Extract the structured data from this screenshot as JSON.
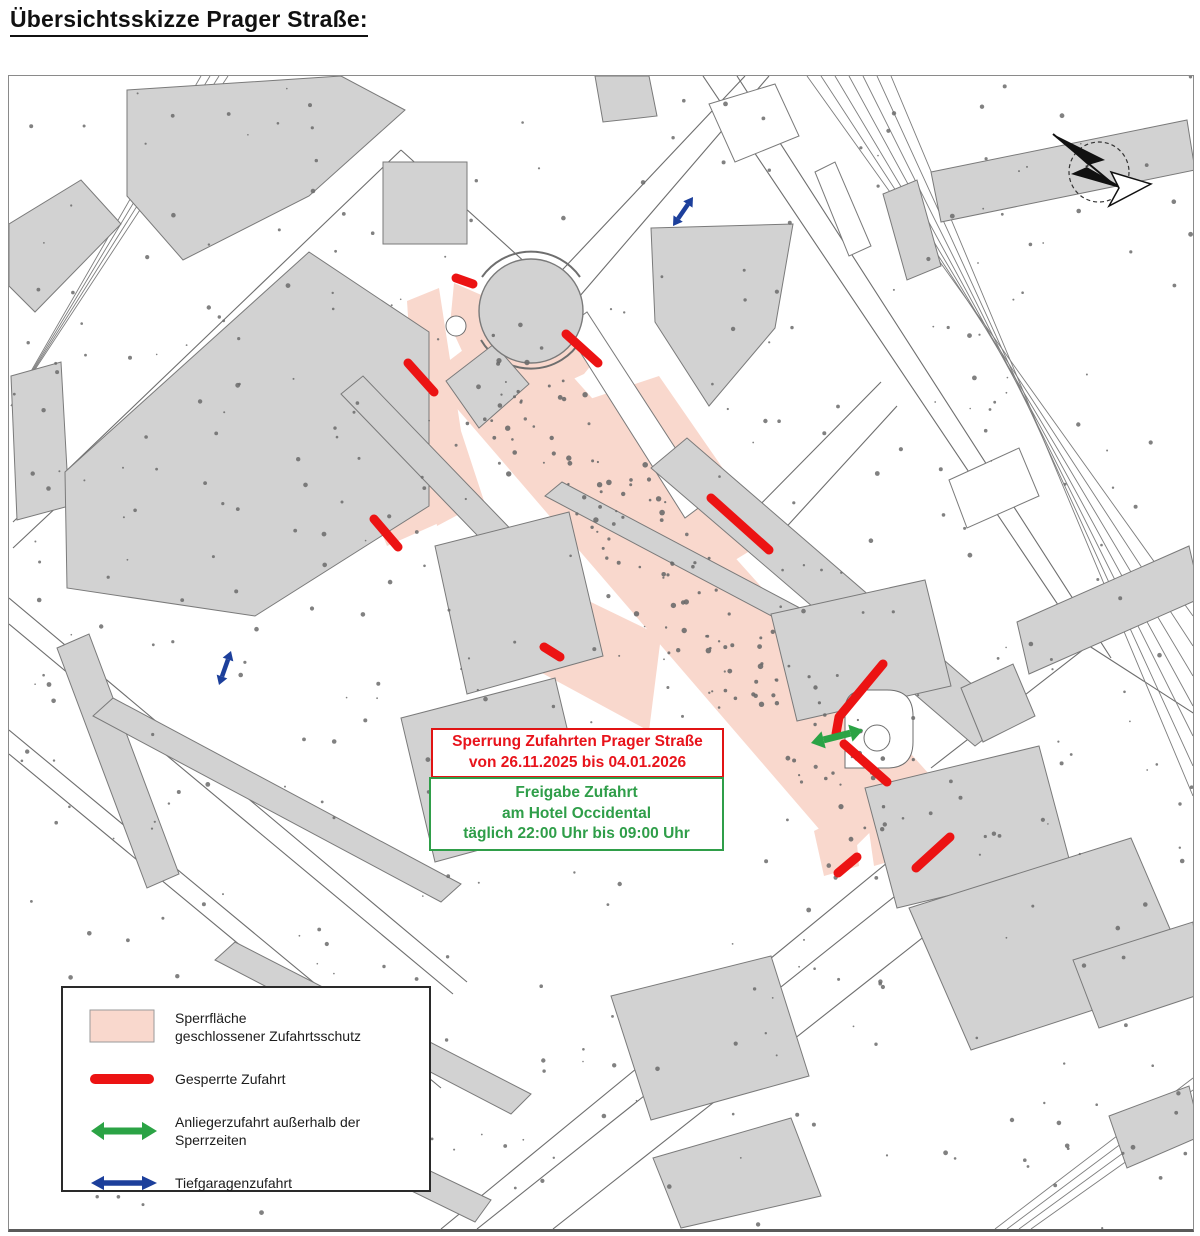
{
  "page": {
    "title": "Übersichtsskizze Prager Straße:"
  },
  "annotations": {
    "closure_box": {
      "line1": "Sperrung Zufahrten Prager Straße",
      "line2": "von 26.11.2025 bis 04.01.2026",
      "text_color": "#e8131b",
      "border_color": "#e11414"
    },
    "release_box": {
      "line1": "Freigabe Zufahrt",
      "line2": "am Hotel Occidental",
      "line3": "täglich 22:00 Uhr bis 09:00 Uhr",
      "text_color": "#2f9e49",
      "border_color": "#2f9e49"
    }
  },
  "legend": {
    "items": [
      {
        "symbol": "area",
        "label_lines": [
          "Sperrfläche",
          "geschlossener Zufahrtsschutz"
        ]
      },
      {
        "symbol": "bar",
        "label_lines": [
          "Gesperrte Zufahrt"
        ]
      },
      {
        "symbol": "green-arrow",
        "label_lines": [
          "Anliegerzufahrt außerhalb der",
          "Sperrzeiten"
        ]
      },
      {
        "symbol": "blue-arrow",
        "label_lines": [
          "Tiefgaragenzufahrt"
        ]
      }
    ]
  },
  "colors": {
    "closure_fill": "#f9d8cd",
    "closure_swatch_stroke": "#9a9a9a",
    "bar_red": "#ec1313",
    "arrow_green": "#2ba345",
    "arrow_blue": "#1c3f9b",
    "building_fill": "#d2d2d2",
    "building_stroke": "#7a7a7a",
    "street": "#6e6e6e",
    "tree": "#6b6b6b"
  },
  "map": {
    "width": 1184,
    "height": 1153,
    "closure_ring": {
      "outer": [
        [
          445,
          207
        ],
        [
          441,
          249
        ],
        [
          459,
          288
        ],
        [
          494,
          312
        ],
        [
          536,
          316
        ],
        [
          575,
          298
        ],
        [
          593,
          276
        ]
      ],
      "inner": [
        [
          568,
          261
        ],
        [
          556,
          276
        ],
        [
          531,
          287
        ],
        [
          504,
          285
        ],
        [
          481,
          269
        ],
        [
          470,
          244
        ],
        [
          472,
          217
        ]
      ]
    },
    "closure_polygons": [
      [
        [
          420,
          300
        ],
        [
          505,
          235
        ],
        [
          920,
          698
        ],
        [
          835,
          782
        ]
      ],
      [
        [
          398,
          225
        ],
        [
          430,
          212
        ],
        [
          452,
          355
        ],
        [
          475,
          425
        ],
        [
          428,
          450
        ],
        [
          403,
          302
        ]
      ],
      [
        [
          362,
          430
        ],
        [
          452,
          392
        ],
        [
          468,
          430
        ],
        [
          378,
          470
        ]
      ],
      [
        [
          462,
          468
        ],
        [
          652,
          560
        ],
        [
          640,
          655
        ],
        [
          520,
          590
        ],
        [
          462,
          520
        ]
      ],
      [
        [
          560,
          330
        ],
        [
          650,
          300
        ],
        [
          762,
          462
        ],
        [
          700,
          500
        ],
        [
          600,
          390
        ]
      ],
      [
        [
          795,
          600
        ],
        [
          872,
          590
        ],
        [
          880,
          705
        ],
        [
          800,
          690
        ]
      ],
      [
        [
          805,
          755
        ],
        [
          845,
          735
        ],
        [
          850,
          790
        ],
        [
          815,
          800
        ]
      ],
      [
        [
          855,
          720
        ],
        [
          925,
          700
        ],
        [
          935,
          770
        ],
        [
          865,
          790
        ]
      ]
    ],
    "streets": [
      [
        540,
        208,
        736,
        0
      ],
      [
        564,
        228,
        760,
        0
      ],
      [
        4,
        446,
        392,
        74
      ],
      [
        4,
        472,
        266,
        226
      ],
      [
        0,
        522,
        458,
        906
      ],
      [
        0,
        548,
        444,
        918
      ],
      [
        0,
        654,
        432,
        1012
      ],
      [
        0,
        678,
        418,
        1024
      ],
      [
        432,
        1153,
        940,
        736
      ],
      [
        468,
        1153,
        964,
        758
      ],
      [
        544,
        1153,
        1002,
        792
      ],
      [
        694,
        0,
        1074,
        566
      ],
      [
        728,
        0,
        1102,
        582
      ],
      [
        1074,
        566,
        1192,
        642
      ],
      [
        872,
        306,
        734,
        446
      ],
      [
        888,
        330,
        760,
        470
      ],
      [
        922,
        692,
        1192,
        482
      ],
      [
        392,
        74,
        540,
        208
      ],
      [
        266,
        226,
        334,
        300
      ]
    ],
    "plaza_arcs": [
      "M473,201 A60,60 0 0 1 571,201",
      "M472,264 A58,58 0 0 0 572,264"
    ],
    "railways": {
      "left": {
        "count": 4,
        "x1": 192,
        "y1": 0,
        "x2": 2,
        "y2": 330,
        "dx": 9,
        "dy": 0
      },
      "right": {
        "count": 7,
        "x1": 798,
        "y1": 0,
        "x2": 1184,
        "y2": 540,
        "dx": 14,
        "dy": 30
      },
      "bottom": {
        "count": 4,
        "x1": 986,
        "y1": 1153,
        "x2": 1184,
        "y2": 1002,
        "dx": 12,
        "dy": 12
      }
    },
    "buildings": [
      [
        [
          118,
          14
        ],
        [
          332,
          0
        ],
        [
          396,
          34
        ],
        [
          300,
          120
        ],
        [
          174,
          184
        ],
        [
          118,
          120
        ]
      ],
      [
        [
          0,
          148
        ],
        [
          72,
          104
        ],
        [
          112,
          148
        ],
        [
          26,
          236
        ],
        [
          0,
          210
        ]
      ],
      [
        [
          2,
          300
        ],
        [
          52,
          286
        ],
        [
          60,
          430
        ],
        [
          8,
          444
        ]
      ],
      [
        [
          56,
          396
        ],
        [
          300,
          176
        ],
        [
          420,
          256
        ],
        [
          420,
          430
        ],
        [
          246,
          540
        ],
        [
          58,
          512
        ]
      ],
      [
        [
          332,
          318
        ],
        [
          354,
          300
        ],
        [
          516,
          468
        ],
        [
          494,
          486
        ]
      ],
      [
        [
          374,
          86
        ],
        [
          458,
          86
        ],
        [
          458,
          168
        ],
        [
          374,
          168
        ]
      ],
      [
        [
          437,
          305
        ],
        [
          485,
          268
        ],
        [
          520,
          308
        ],
        [
          470,
          352
        ]
      ],
      [
        [
          642,
          152
        ],
        [
          784,
          148
        ],
        [
          766,
          252
        ],
        [
          700,
          330
        ],
        [
          646,
          246
        ]
      ],
      [
        [
          642,
          392
        ],
        [
          678,
          362
        ],
        [
          1002,
          642
        ],
        [
          966,
          670
        ]
      ],
      [
        [
          536,
          420
        ],
        [
          553,
          406
        ],
        [
          806,
          540
        ],
        [
          789,
          554
        ]
      ],
      [
        [
          426,
          470
        ],
        [
          560,
          436
        ],
        [
          594,
          580
        ],
        [
          458,
          618
        ]
      ],
      [
        [
          392,
          642
        ],
        [
          546,
          602
        ],
        [
          580,
          744
        ],
        [
          426,
          786
        ]
      ],
      [
        [
          762,
          538
        ],
        [
          916,
          504
        ],
        [
          942,
          610
        ],
        [
          788,
          645
        ]
      ],
      [
        [
          856,
          712
        ],
        [
          1030,
          670
        ],
        [
          1062,
          790
        ],
        [
          888,
          832
        ]
      ],
      [
        [
          900,
          832
        ],
        [
          1122,
          762
        ],
        [
          1182,
          902
        ],
        [
          962,
          974
        ]
      ],
      [
        [
          48,
          572
        ],
        [
          80,
          558
        ],
        [
          170,
          798
        ],
        [
          138,
          812
        ]
      ],
      [
        [
          84,
          640
        ],
        [
          104,
          622
        ],
        [
          452,
          808
        ],
        [
          432,
          826
        ]
      ],
      [
        [
          206,
          884
        ],
        [
          226,
          866
        ],
        [
          522,
          1018
        ],
        [
          502,
          1038
        ]
      ],
      [
        [
          286,
          1058
        ],
        [
          306,
          1040
        ],
        [
          482,
          1124
        ],
        [
          466,
          1146
        ]
      ],
      [
        [
          602,
          920
        ],
        [
          762,
          880
        ],
        [
          800,
          1000
        ],
        [
          642,
          1044
        ]
      ],
      [
        [
          644,
          1082
        ],
        [
          782,
          1042
        ],
        [
          812,
          1120
        ],
        [
          672,
          1152
        ]
      ],
      [
        [
          922,
          96
        ],
        [
          1178,
          44
        ],
        [
          1186,
          94
        ],
        [
          932,
          146
        ]
      ],
      [
        [
          874,
          118
        ],
        [
          908,
          104
        ],
        [
          932,
          190
        ],
        [
          898,
          204
        ]
      ],
      [
        [
          1008,
          546
        ],
        [
          1180,
          470
        ],
        [
          1192,
          522
        ],
        [
          1020,
          598
        ]
      ],
      [
        [
          1064,
          884
        ],
        [
          1184,
          846
        ],
        [
          1192,
          918
        ],
        [
          1090,
          952
        ]
      ],
      [
        [
          586,
          0
        ],
        [
          640,
          0
        ],
        [
          648,
          40
        ],
        [
          594,
          46
        ]
      ],
      [
        [
          952,
          612
        ],
        [
          1004,
          588
        ],
        [
          1026,
          640
        ],
        [
          974,
          666
        ]
      ],
      [
        [
          1100,
          1040
        ],
        [
          1180,
          1010
        ],
        [
          1192,
          1060
        ],
        [
          1118,
          1092
        ]
      ]
    ],
    "white_buildings": [
      [
        [
          556,
          252
        ],
        [
          578,
          236
        ],
        [
          700,
          424
        ],
        [
          676,
          442
        ]
      ],
      [
        [
          700,
          28
        ],
        [
          766,
          8
        ],
        [
          790,
          60
        ],
        [
          726,
          86
        ]
      ],
      [
        [
          806,
          96
        ],
        [
          826,
          86
        ],
        [
          862,
          170
        ],
        [
          840,
          180
        ]
      ],
      [
        [
          940,
          404
        ],
        [
          1010,
          372
        ],
        [
          1030,
          420
        ],
        [
          958,
          452
        ]
      ]
    ],
    "circle_building": {
      "cx": 522,
      "cy": 235,
      "r": 52
    },
    "plaza_circle": {
      "cx": 447,
      "cy": 250,
      "r": 10
    },
    "hotel_loop": {
      "path": "M836,692 L836,634 Q836,614 858,614 L878,614 Q904,614 904,640 L904,666 Q904,692 878,692 Z",
      "circle": {
        "cx": 868,
        "cy": 662,
        "r": 13
      }
    },
    "closed_access_bars": [
      [
        447,
        202,
        464,
        208
      ],
      [
        557,
        258,
        589,
        287
      ],
      [
        399,
        287,
        425,
        316
      ],
      [
        365,
        443,
        389,
        471
      ],
      [
        535,
        571,
        551,
        581
      ],
      [
        702,
        422,
        760,
        474
      ],
      [
        835,
        668,
        878,
        706
      ],
      [
        829,
        797,
        848,
        781
      ],
      [
        907,
        792,
        941,
        761
      ]
    ],
    "closed_access_polyline": [
      [
        874,
        588
      ],
      [
        830,
        641
      ],
      [
        827,
        658
      ]
    ],
    "resident_access_arrow": {
      "x1": 802,
      "y1": 667,
      "x2": 854,
      "y2": 654
    },
    "garage_arrows": [
      {
        "x1": 664,
        "y1": 150,
        "x2": 684,
        "y2": 121
      },
      {
        "x1": 210,
        "y1": 609,
        "x2": 222,
        "y2": 575
      }
    ],
    "north_arrow": {
      "cx": 1090,
      "cy": 96,
      "r": 30,
      "bolt": [
        [
          1044,
          58
        ],
        [
          1096,
          84
        ],
        [
          1076,
          90
        ],
        [
          1118,
          114
        ],
        [
          1062,
          98
        ],
        [
          1080,
          90
        ]
      ],
      "tail": [
        1044,
        58,
        1104,
        108
      ],
      "head": [
        [
          1102,
          96
        ],
        [
          1142,
          108
        ],
        [
          1100,
          130
        ],
        [
          1110,
          112
        ]
      ]
    }
  }
}
